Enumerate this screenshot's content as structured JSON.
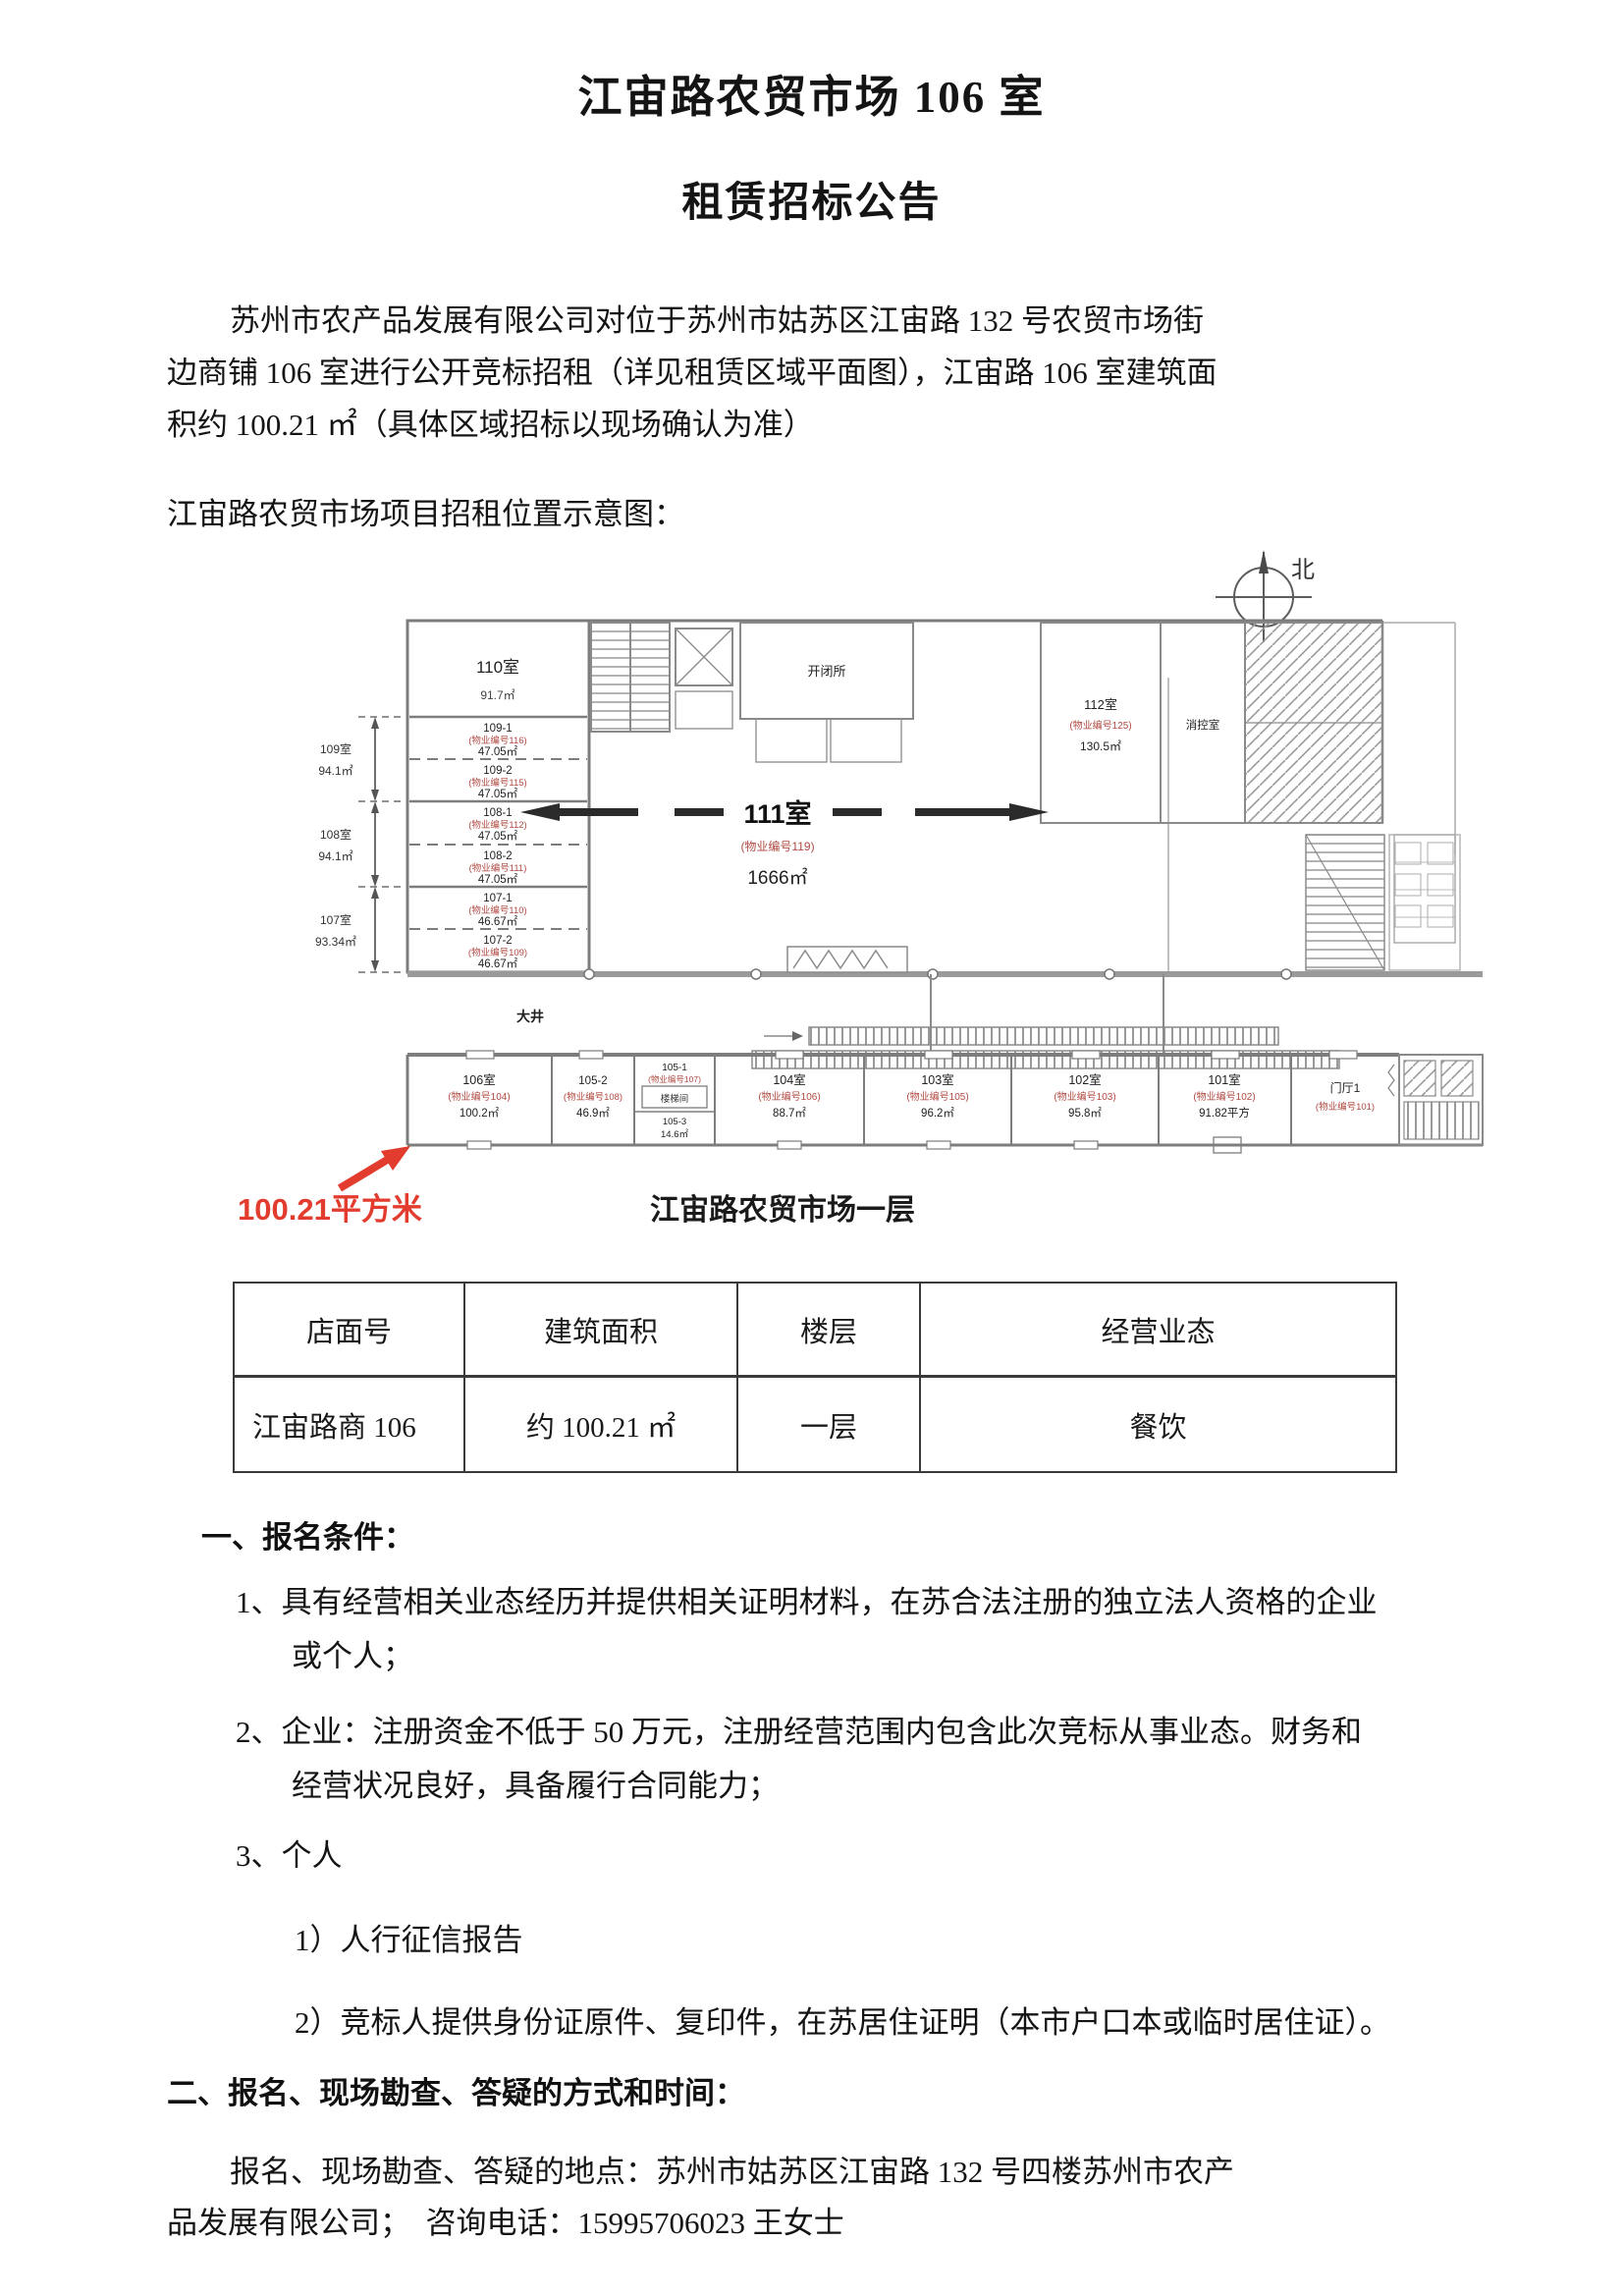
{
  "header": {
    "title_line1": "江宙路农贸市场 106 室",
    "title_line2": "租赁招标公告"
  },
  "intro": {
    "lines": [
      "苏州市农产品发展有限公司对位于苏州市姑苏区江宙路 132 号农贸市场街",
      "边商铺 106 室进行公开竞标招租（详见租赁区域平面图），江宙路 106 室建筑面",
      "积约 100.21 ㎡（具体区域招标以现场确认为准）"
    ],
    "plan_intro": "江宙路农贸市场项目招租位置示意图："
  },
  "floor_plan": {
    "north_label": "北",
    "center_room": {
      "name": "111室",
      "code": "(物业编号119)",
      "area": "1666㎡"
    },
    "courtyard_label": "大井",
    "highlight_area_label": "100.21平方米",
    "plan_caption": "江宙路农贸市场一层",
    "left_rooms": [
      {
        "name": "110室",
        "code": "",
        "area": "91.7㎡"
      },
      {
        "name": "109-1",
        "code": "(物业编号116)",
        "area": "47.05㎡"
      },
      {
        "name": "109-2",
        "code": "(物业编号115)",
        "area": "47.05㎡"
      },
      {
        "name": "108-1",
        "code": "(物业编号112)",
        "area": "47.05㎡"
      },
      {
        "name": "108-2",
        "code": "(物业编号111)",
        "area": "47.05㎡"
      },
      {
        "name": "107-1",
        "code": "(物业编号110)",
        "area": "46.67㎡"
      },
      {
        "name": "107-2",
        "code": "(物业编号109)",
        "area": "46.67㎡"
      }
    ],
    "left_dims": [
      {
        "name": "109室",
        "area": "94.1㎡"
      },
      {
        "name": "108室",
        "area": "94.1㎡"
      },
      {
        "name": "107室",
        "area": "93.34㎡"
      }
    ],
    "top_rooms": [
      {
        "name": "开闭所"
      },
      {
        "name": "112室",
        "code": "(物业编号125)",
        "area": "130.5㎡"
      },
      {
        "name": "消控室"
      }
    ],
    "bottom_rooms": [
      {
        "name": "106室",
        "code": "(物业编号104)",
        "area": "100.2㎡"
      },
      {
        "name": "105-2",
        "code": "(物业编号108)",
        "area": "46.9㎡"
      },
      {
        "name": "105-1",
        "code": "(物业编号107)",
        "area": ""
      },
      {
        "name": "104室",
        "code": "(物业编号106)",
        "area": "88.7㎡"
      },
      {
        "name": "103室",
        "code": "(物业编号105)",
        "area": "96.2㎡"
      },
      {
        "name": "102室",
        "code": "(物业编号103)",
        "area": "95.8㎡"
      },
      {
        "name": "101室",
        "code": "(物业编号102)",
        "area": "91.82平方"
      },
      {
        "name": "门厅1",
        "code": "(物业编号101)",
        "area": ""
      }
    ],
    "sub_room": {
      "name": "105-3",
      "area": "14.6㎡"
    },
    "stair_label": "楼梯间"
  },
  "table": {
    "headers": [
      "店面号",
      "建筑面积",
      "楼层",
      "经营业态"
    ],
    "rows": [
      [
        "江宙路商 106",
        "约 100.21 ㎡",
        "一层",
        "餐饮"
      ]
    ]
  },
  "sections": {
    "s1_title": "一、报名条件：",
    "s1_items": [
      {
        "lines": [
          "1、具有经营相关业态经历并提供相关证明材料，在苏合法注册的独立法人资格的企业",
          "或个人；"
        ]
      },
      {
        "lines": [
          "2、企业：注册资金不低于 50 万元，注册经营范围内包含此次竞标从事业态。财务和",
          "经营状况良好，具备履行合同能力；"
        ]
      },
      {
        "lines": [
          "3、个人"
        ]
      }
    ],
    "s1_subitems": [
      "1）人行征信报告",
      "2）竞标人提供身份证原件、复印件，在苏居住证明（本市户口本或临时居住证）。"
    ],
    "s2_title": "二、报名、现场勘查、答疑的方式和时间：",
    "s2_lines": [
      "报名、现场勘查、答疑的地点：苏州市姑苏区江宙路 132 号四楼苏州市农产",
      "品发展有限公司；　咨询电话：15995706023 王女士"
    ]
  }
}
